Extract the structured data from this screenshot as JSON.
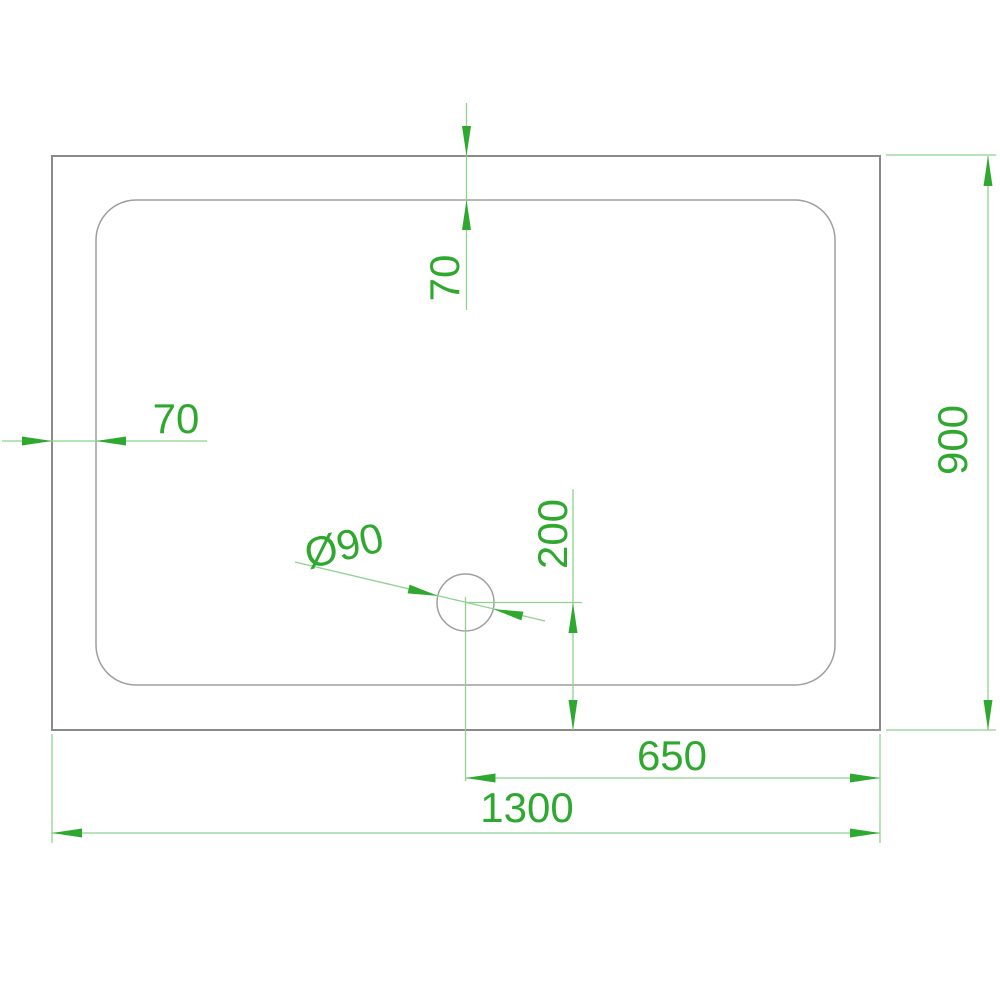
{
  "drawing": {
    "colors": {
      "dim_accent": "#2fa82f",
      "dim_line": "#8ed28e",
      "object_line": "#8a8a8a",
      "inner_line": "#9e9e9e",
      "background": "#ffffff"
    }
  },
  "dims": {
    "rim_top": {
      "label": "70"
    },
    "rim_left": {
      "label": "70"
    },
    "depth": {
      "label": "900"
    },
    "drain_height": {
      "label": "200"
    },
    "drain_diameter": {
      "label": "Ø90"
    },
    "drain_right": {
      "label": "650"
    },
    "width": {
      "label": "1300"
    }
  }
}
